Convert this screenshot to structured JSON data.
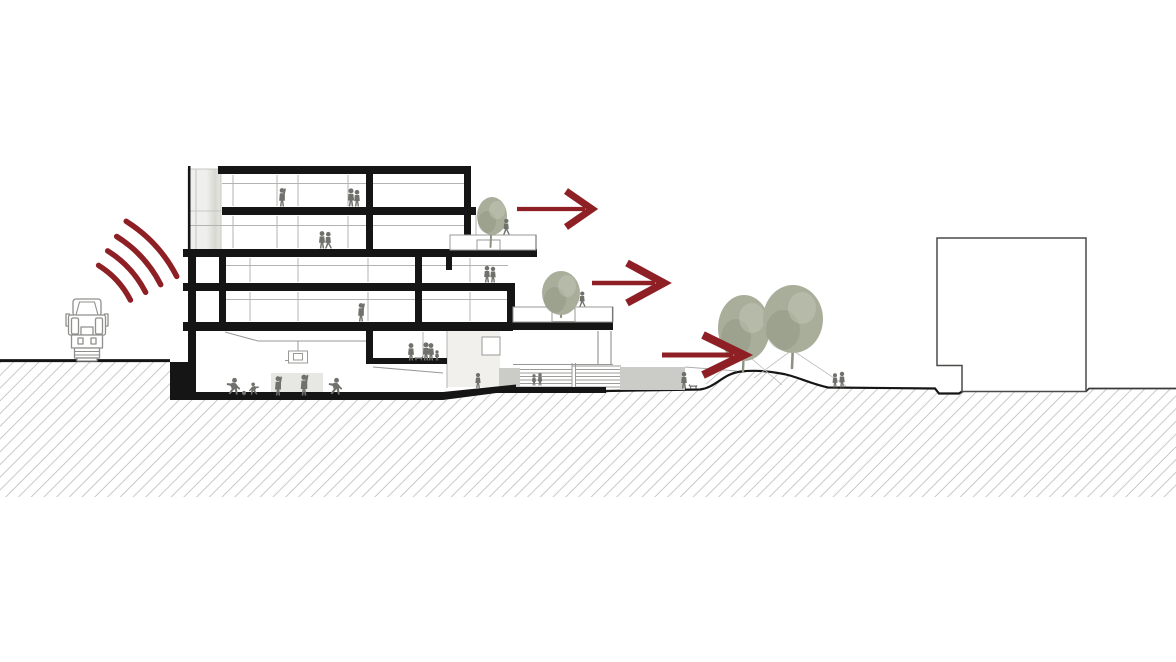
{
  "diagram": {
    "label": "Architectural cross-section: truck noise source emitting sound waves at left, sectioned building with stepped roof terraces and basement gym, three red arrows pointing right toward a planted mound, neighbouring building outline at right",
    "scene": {
      "noise_source": "truck-front-view",
      "sound_wave_arcs": 4,
      "building_levels": 5,
      "roof_terraces": 2,
      "terrace_trees": 2,
      "mound_trees": 2,
      "view_arrows": 3,
      "people_silhouettes": 24,
      "dogs": 2,
      "basketball_hoops": 1,
      "amphitheater_steps": 6,
      "neighbour_buildings": 1
    },
    "icons": {
      "truck": "truck-front-icon",
      "waves": "sound-waves-icon",
      "arrows": "right-arrow-icon",
      "tree": "tree-icon",
      "person": "person-silhouette-icon",
      "dog": "dog-silhouette-icon",
      "hoop": "basketball-hoop-icon"
    }
  },
  "colors": {
    "accent_red": "#8E2025",
    "ink_black": "#151515",
    "tree_green": "#A9AE9B",
    "tree_green_dark": "#7E8470",
    "trunk_green": "#8D9383",
    "figure_gray": "#70706C",
    "hatch_gray": "#C9C9C9",
    "outline_gray": "#999995",
    "mullion_gray": "#B3B3AF",
    "panel_gray_light": "#EFEFED",
    "panel_gray_dark": "#D8D8D3",
    "block_gray": "#CBCBC7",
    "mat_gray": "#E7E7E3",
    "truck_gray": "#8F8F8C",
    "background": "#FFFFFF"
  }
}
